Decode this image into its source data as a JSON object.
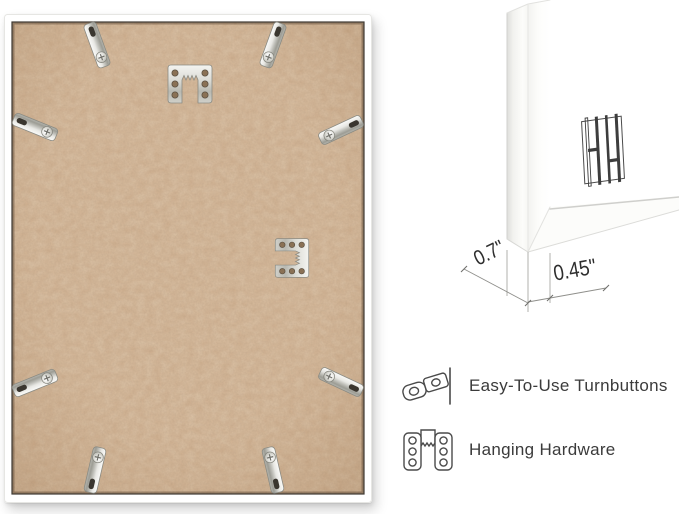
{
  "image": {
    "background_color": "#ffffff",
    "subject": "picture frame back with mounting hardware"
  },
  "frame_back": {
    "board_color": "#cfae8d",
    "frame_color": "#ffffff",
    "turnbutton_count": 8,
    "hanger_count": 2
  },
  "closeup": {
    "logo_icon": "hh-monogram-logo",
    "dimensions": {
      "depth_label": "0.7\"",
      "face_label": "0.45\""
    }
  },
  "features": [
    {
      "icon": "turnbutton-icon",
      "label": "Easy-To-Use Turnbuttons"
    },
    {
      "icon": "hanging-hardware-icon",
      "label": "Hanging Hardware"
    }
  ]
}
